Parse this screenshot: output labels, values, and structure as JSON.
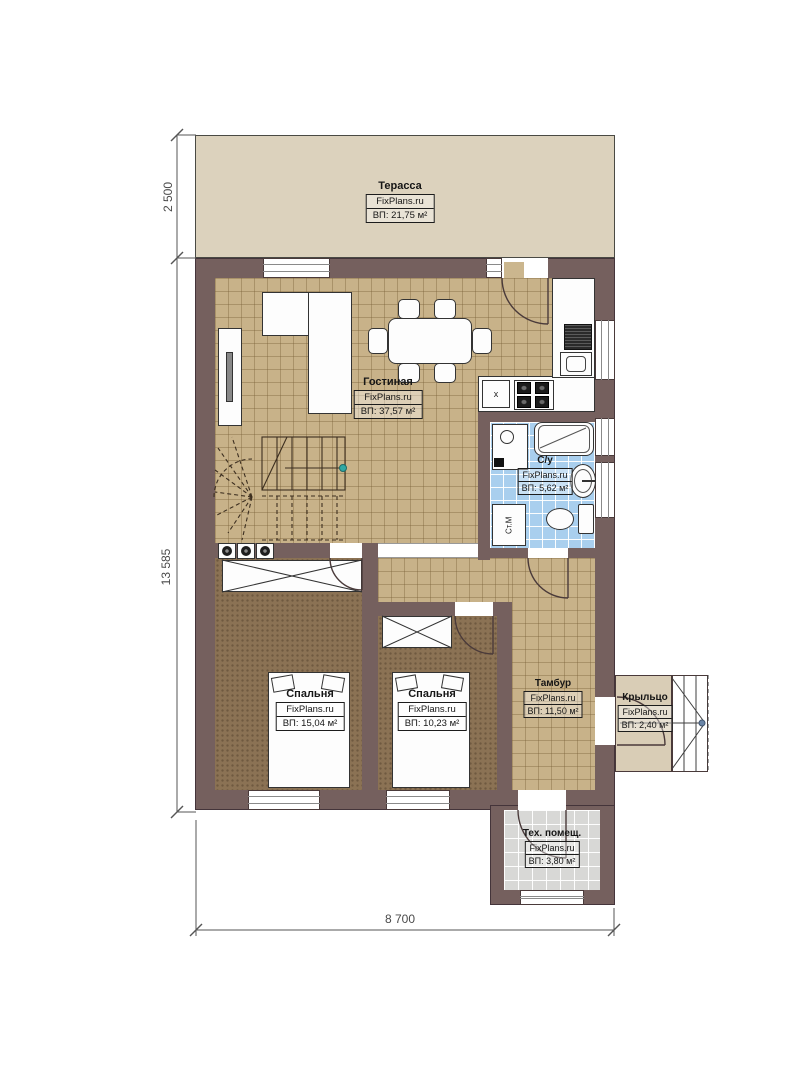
{
  "plan": {
    "brand": "FixPlans.ru",
    "type": "floor-plan"
  },
  "rooms": [
    {
      "id": "terrace",
      "name": "Терасса",
      "brand": "FixPlans.ru",
      "area": "ВП: 21,75 м²"
    },
    {
      "id": "living",
      "name": "Гостиная",
      "brand": "FixPlans.ru",
      "area": "ВП: 37,57 м²"
    },
    {
      "id": "bathroom",
      "name": "С/у",
      "brand": "FixPlans.ru",
      "area": "ВП: 5,62 м²"
    },
    {
      "id": "bedroom1",
      "name": "Спальня",
      "brand": "FixPlans.ru",
      "area": "ВП: 15,04 м²"
    },
    {
      "id": "bedroom2",
      "name": "Спальня",
      "brand": "FixPlans.ru",
      "area": "ВП: 10,23 м²"
    },
    {
      "id": "vestibule",
      "name": "Тамбур",
      "brand": "FixPlans.ru",
      "area": "ВП: 11,50 м²"
    },
    {
      "id": "porch",
      "name": "Крыльцо",
      "brand": "FixPlans.ru",
      "area": "ВП: 2,40 м²"
    },
    {
      "id": "tech",
      "name": "Тех. помещ.",
      "brand": "FixPlans.ru",
      "area": "ВП: 3,80 м²"
    }
  ],
  "fixtures": {
    "washing_machine": "Ст.М",
    "sink_mark": "x"
  },
  "dimensions": {
    "left_top": "2 500",
    "left_main": "13 585",
    "bottom": "8 700"
  },
  "colors": {
    "wall": "#75605e",
    "terrace_floor": "#dcd2bd",
    "living_tile": "#c8b289",
    "bedroom_floor": "#8b7254",
    "bathroom_tile": "#a9cfee",
    "tech_tile": "#d8d8d6",
    "stair_marker": "#2fa8a4"
  }
}
